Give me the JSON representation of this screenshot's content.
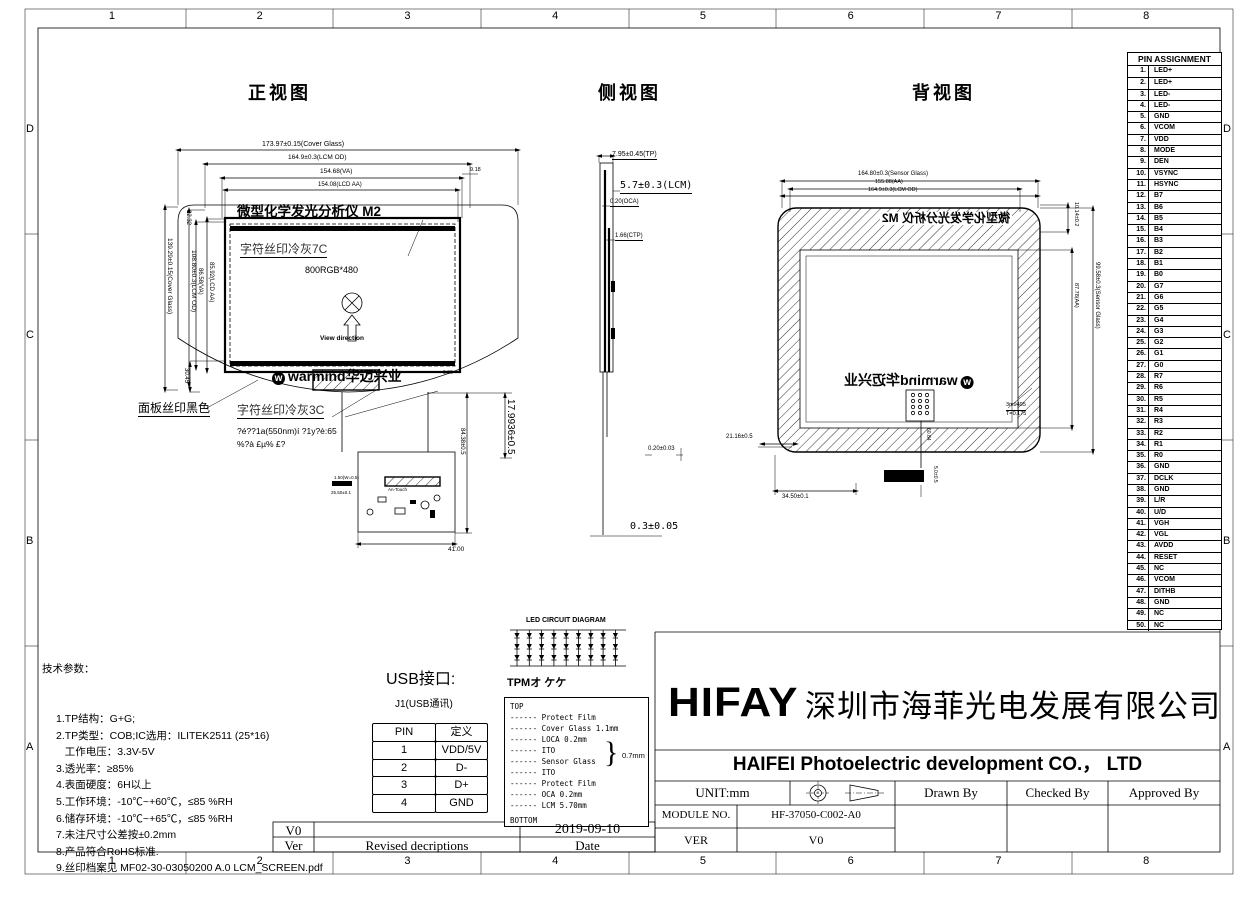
{
  "sheet": {
    "cols": [
      "1",
      "2",
      "3",
      "4",
      "5",
      "6",
      "7",
      "8"
    ],
    "rows": [
      "D",
      "C",
      "B",
      "A"
    ]
  },
  "views": {
    "front": {
      "title": "正视图",
      "dim_cover_w": "173.97±0.15(Cover Glass)",
      "dim_lcm_w": "164.9±0.3(LCM OD)",
      "dim_va_w": "154.68(VA)",
      "dim_aa_w": "154.08(LCD AA)",
      "dim_918": "9.18",
      "screen_title": "微型化学发光分析仪 M2",
      "silk_gray7c": "字符丝印冷灰7C",
      "resolution": "800RGB*480",
      "view_direction": "View direction",
      "logo_text": "warmind华迈兴业",
      "panel_black": "面板丝印黑色",
      "silk_gray3c": "字符丝印冷灰3C",
      "note_line1": "?é??1a(550nm)í ?1y?è:65",
      "note_line2": "%?à £µ% £?",
      "dim_2232": "22.32",
      "dim_cover_h": "139.29±0.15(Cover Glass)",
      "dim_lcm_h": "108.80±0.3(LCM OD)",
      "dim_va_h": "86.58(VA)",
      "dim_aa_h": "85.92(LCD AA)",
      "dim_3045": "30.45",
      "dim_963": "9.63",
      "dim_8438": "84.38±0.5",
      "dim_1799": "17.9936±0.5",
      "dim_150": "1.50(W=0.5)",
      "dim_2550": "25.50±0.1",
      "dim_4100": "41.00",
      "fpc_label": "An-Touch"
    },
    "side": {
      "title": "侧视图",
      "dim_tp": "7.95±0.45(TP)",
      "dim_lcm": "5.7±0.3(LCM)",
      "dim_oca": "0.20(OCA)",
      "dim_ctp": "1.66(CTP)",
      "dim_020": "0.20±0.03",
      "dim_03": "0.3±0.05"
    },
    "back": {
      "title": "背视图",
      "dim_sensor_w": "164.80±0.3(Sensor Glass)",
      "dim_aa_w": "155.88(AA)",
      "dim_lcm_w": "164.9±0.3(LCM OD)",
      "mirror_title": "微型化学发光分析仪 M2",
      "mirror_logo": "warmind华迈兴业",
      "dim_1014": "10.14±0.2",
      "dim_sensor_h": "99.58±0.3(Sensor Glass)",
      "dim_aa_h": "87.78(AA)",
      "dim_2116": "21.16±0.5",
      "dim_3450": "34.50±0.1",
      "dim_6084": "60.84",
      "dim_50": "5.0±0.5",
      "tape_note1": "3m9495",
      "tape_note2": "T=0.175"
    }
  },
  "pin_table": {
    "title": "PIN ASSIGNMENT",
    "pins": [
      "LED+",
      "LED+",
      "LED-",
      "LED-",
      "GND",
      "VCOM",
      "VDD",
      "MODE",
      "DEN",
      "VSYNC",
      "HSYNC",
      "B7",
      "B6",
      "B5",
      "B4",
      "B3",
      "B2",
      "B1",
      "B0",
      "G7",
      "G6",
      "G5",
      "G4",
      "G3",
      "G2",
      "G1",
      "G0",
      "R7",
      "R6",
      "R5",
      "R4",
      "R3",
      "R2",
      "R1",
      "R0",
      "GND",
      "DCLK",
      "GND",
      "L/R",
      "U/D",
      "VGH",
      "VGL",
      "AVDD",
      "RESET",
      "NC",
      "VCOM",
      "DITHB",
      "GND",
      "NC",
      "NC"
    ]
  },
  "tech": {
    "title": "技术参数：",
    "lines": [
      "1.TP结构：G+G;",
      "2.TP类型：COB;IC选用：ILITEK2511 (25*16)",
      "   工作电压：3.3V-5V",
      "3.透光率：≥85%",
      "4.表面硬度：6H以上",
      "5.工作环境：-10℃~+60℃，≤85 %RH",
      "6.储存环境：-10℃~+65℃，≤85 %RH",
      "7.未注尺寸公差按±0.2mm",
      "8.产品符合RoHS标准.",
      "9.丝印档案见 MF02-30-03050200 A.0 LCM_SCREEN.pdf"
    ]
  },
  "usb": {
    "title": "USB接口:",
    "subtitle": "J1(USB通讯)",
    "col_pin": "PIN",
    "col_def": "定义",
    "rows": [
      [
        "1",
        "VDD/5V"
      ],
      [
        "2",
        "D-"
      ],
      [
        "3",
        "D+"
      ],
      [
        "4",
        "GND"
      ]
    ]
  },
  "led": {
    "title": "LED CIRCUIT DIAGRAM"
  },
  "tpm": {
    "title": "TPMオ ケケ",
    "top": "TOP",
    "layers": [
      "------ Protect Film",
      "------ Cover Glass 1.1mm",
      "------ LOCA 0.2mm",
      "------ ITO",
      "------ Sensor Glass",
      "------ ITO",
      "------ Protect Film",
      "------ OCA  0.2mm",
      "------ LCM  5.70mm"
    ],
    "brace_label": "0.7mm",
    "bottom": "BOTTOM"
  },
  "titleblock": {
    "logo": "HIFAY",
    "company_cn": "深圳市海菲光电发展有限公司",
    "company_en": "HAIFEI Photoelectric development CO.， LTD",
    "unit": "UNIT:mm",
    "drawn": "Drawn By",
    "checked": "Checked By",
    "approved": "Approved By",
    "module_label": "MODULE NO.",
    "module_no": "HF-37050-C002-A0",
    "ver_label": "VER",
    "ver": "V0"
  },
  "revision": {
    "ver": "V0",
    "date": "2019-09-10",
    "col_ver": "Ver",
    "col_desc": "Revised decriptions",
    "col_date": "Date"
  }
}
